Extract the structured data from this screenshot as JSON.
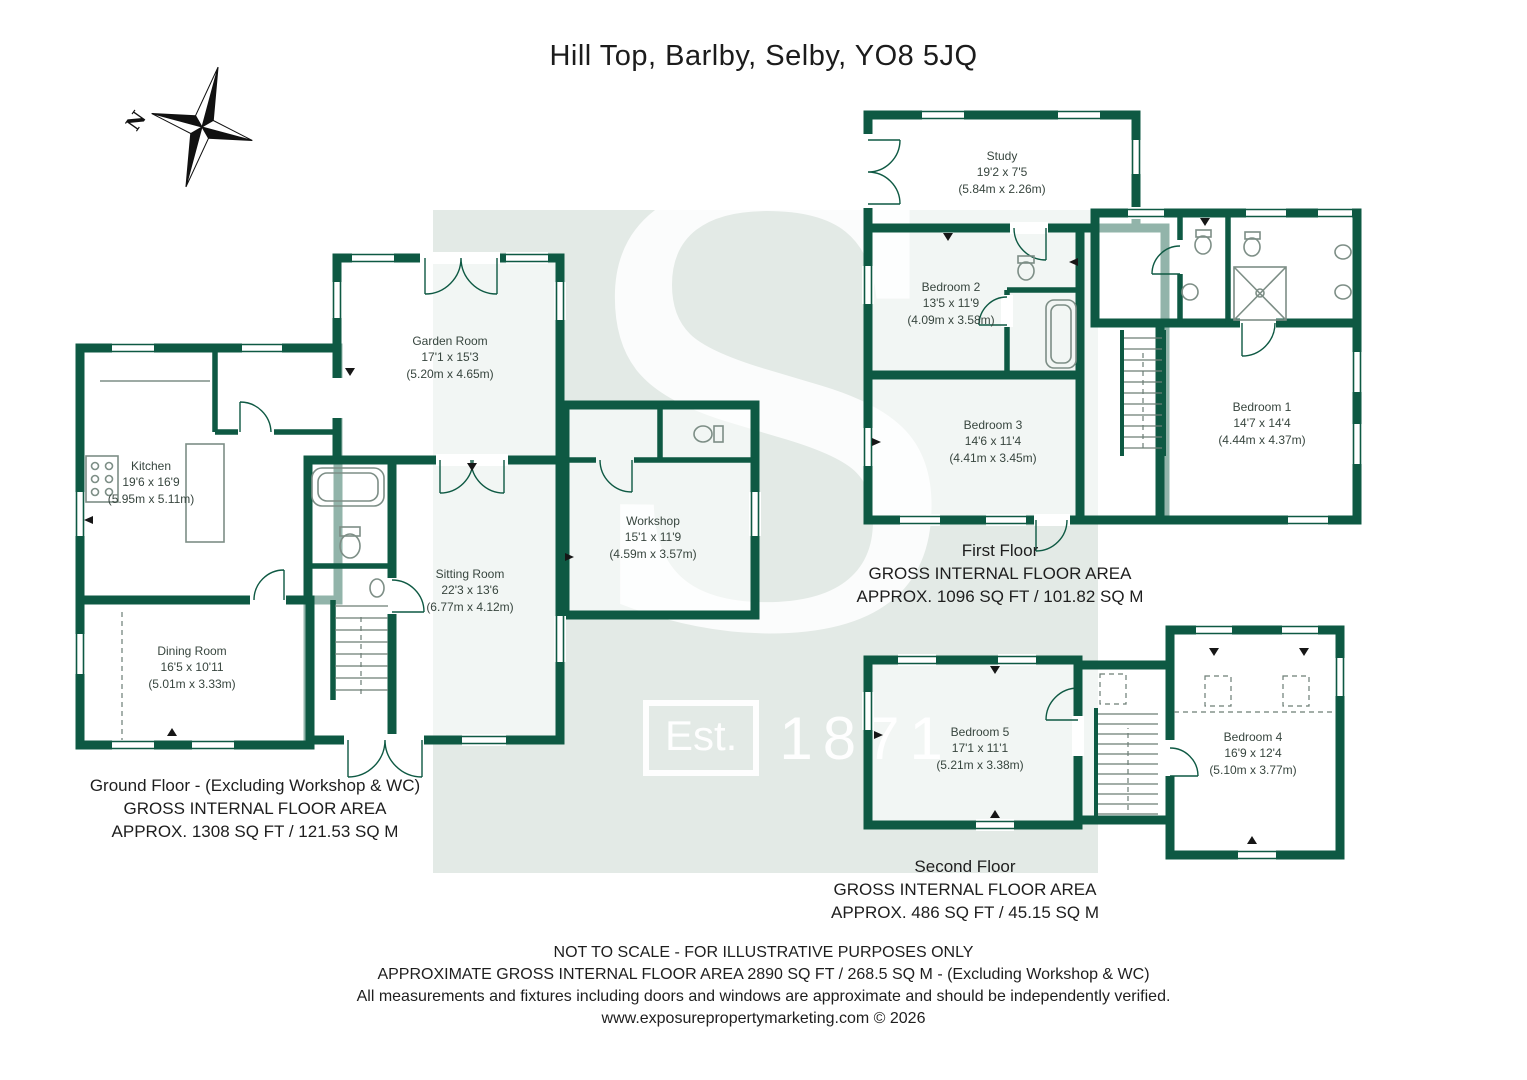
{
  "title": "Hill Top, Barlby, Selby, YO8 5JQ",
  "compass": {
    "north_label": "N"
  },
  "watermark": {
    "letter": "S",
    "est": "Est.",
    "year": "1871"
  },
  "colors": {
    "wall": "#0E5943",
    "watermark_bg": "#E3EAE6"
  },
  "rooms": {
    "kitchen": {
      "name": "Kitchen",
      "imperial": "19'6 x 16'9",
      "metric": "(5.95m x 5.11m)"
    },
    "garden_room": {
      "name": "Garden Room",
      "imperial": "17'1 x 15'3",
      "metric": "(5.20m x 4.65m)"
    },
    "sitting_room": {
      "name": "Sitting Room",
      "imperial": "22'3 x 13'6",
      "metric": "(6.77m x 4.12m)"
    },
    "dining_room": {
      "name": "Dining Room",
      "imperial": "16'5 x 10'11",
      "metric": "(5.01m x 3.33m)"
    },
    "workshop": {
      "name": "Workshop",
      "imperial": "15'1 x 11'9",
      "metric": "(4.59m x 3.57m)"
    },
    "study": {
      "name": "Study",
      "imperial": "19'2 x 7'5",
      "metric": "(5.84m x 2.26m)"
    },
    "bedroom1": {
      "name": "Bedroom 1",
      "imperial": "14'7 x 14'4",
      "metric": "(4.44m x 4.37m)"
    },
    "bedroom2": {
      "name": "Bedroom 2",
      "imperial": "13'5 x 11'9",
      "metric": "(4.09m x 3.58m)"
    },
    "bedroom3": {
      "name": "Bedroom 3",
      "imperial": "14'6 x 11'4",
      "metric": "(4.41m x 3.45m)"
    },
    "bedroom4": {
      "name": "Bedroom 4",
      "imperial": "16'9 x 12'4",
      "metric": "(5.10m x 3.77m)"
    },
    "bedroom5": {
      "name": "Bedroom 5",
      "imperial": "17'1 x 11'1",
      "metric": "(5.21m x 3.38m)"
    }
  },
  "floors": {
    "ground": {
      "line1": "Ground Floor - (Excluding Workshop & WC)",
      "line2": "GROSS INTERNAL FLOOR AREA",
      "line3": "APPROX. 1308 SQ FT / 121.53 SQ M"
    },
    "first": {
      "line1": "First Floor",
      "line2": "GROSS INTERNAL FLOOR AREA",
      "line3": "APPROX. 1096 SQ FT / 101.82 SQ M"
    },
    "second": {
      "line1": "Second Floor",
      "line2": "GROSS INTERNAL FLOOR AREA",
      "line3": "APPROX. 486 SQ FT / 45.15 SQ M"
    }
  },
  "footer": {
    "line1": "NOT TO SCALE - FOR ILLUSTRATIVE PURPOSES ONLY",
    "line2": "APPROXIMATE GROSS INTERNAL FLOOR AREA 2890 SQ FT / 268.5 SQ M - (Excluding Workshop & WC)",
    "line3": "All measurements and fixtures including doors and windows are approximate and should be independently verified.",
    "line4": "www.exposurepropertymarketing.com © 2026"
  }
}
